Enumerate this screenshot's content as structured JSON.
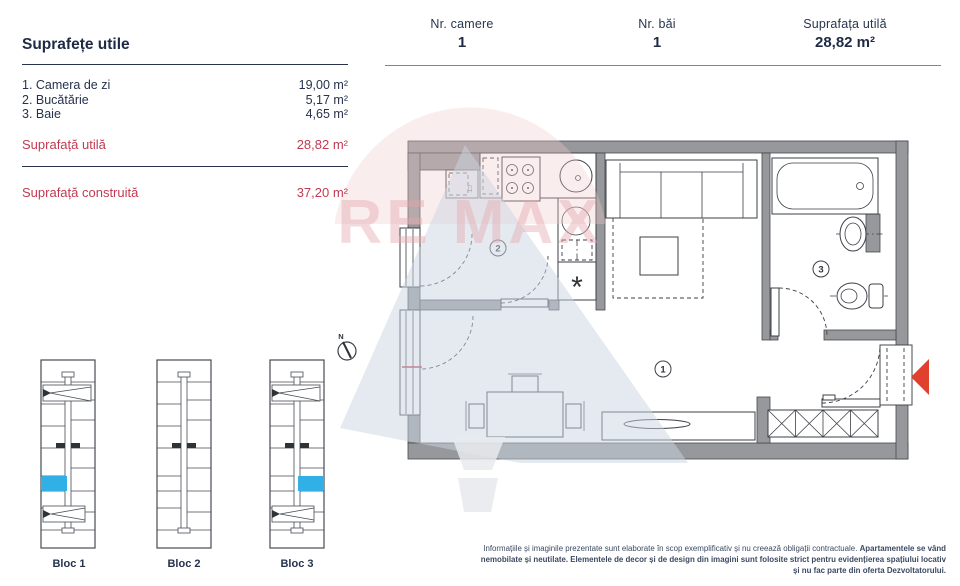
{
  "header": {
    "stats": [
      {
        "label": "Nr. camere",
        "value": "1"
      },
      {
        "label": "Nr. băi",
        "value": "1"
      },
      {
        "label": "Suprafața utilă",
        "value": "28,82 m²"
      }
    ]
  },
  "surfaces": {
    "title": "Suprafețe utile",
    "rows": [
      {
        "label": "1. Camera de zi",
        "value": "19,00 m²"
      },
      {
        "label": "2. Bucătărie",
        "value": "5,17 m²"
      },
      {
        "label": "3. Baie",
        "value": "4,65 m²"
      }
    ],
    "useful": {
      "label": "Suprafață utilă",
      "value": "28,82 m²"
    },
    "built": {
      "label": "Suprafață construită",
      "value": "37,20 m²"
    }
  },
  "plan": {
    "rooms": [
      {
        "number": "1"
      },
      {
        "number": "2"
      },
      {
        "number": "3"
      }
    ],
    "washer_symbol": "*",
    "boiler_label": "CT",
    "compass_label": "N"
  },
  "watermark": {
    "text": "RE MAX"
  },
  "blocks": [
    {
      "label": "Bloc 1",
      "highlighted": true
    },
    {
      "label": "Bloc 2",
      "highlighted": false
    },
    {
      "label": "Bloc 3",
      "highlighted": true
    }
  ],
  "footer": {
    "disclaimer_1": "Informațiile și imaginile prezentate sunt elaborate în scop exemplificativ și nu creează obligații contractuale.",
    "disclaimer_2": "Apartamentele se vând nemobilate și neutilate. Elementele de decor și de design din imagini sunt folosite strict pentru evidențierea spațiului locativ și nu fac parte din oferta Dezvoltatorului."
  },
  "colors": {
    "highlight_blue": "#31b0e5",
    "arrow_red": "#e2402f",
    "red_text": "#c23a52",
    "navy_text": "#232f49"
  }
}
